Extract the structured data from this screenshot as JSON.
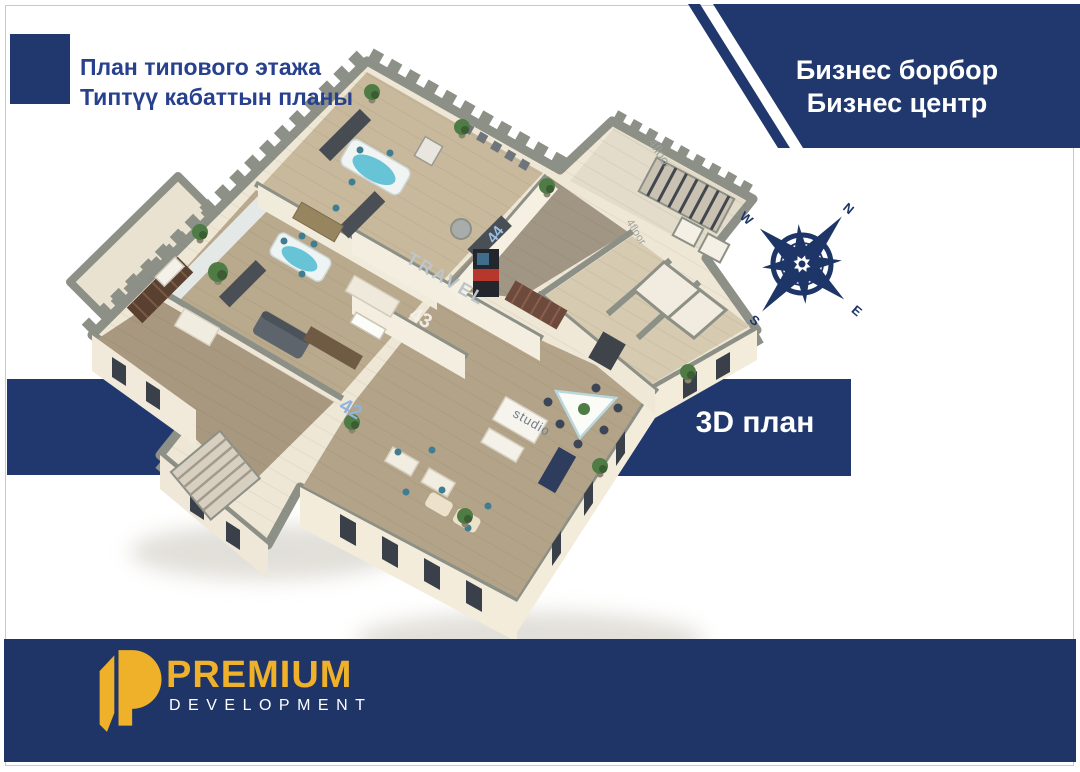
{
  "canvas": {
    "width": 1080,
    "height": 772,
    "background": "#ffffff",
    "frame_color": "#c6c9cf"
  },
  "brand_colors": {
    "navy": "#21386e",
    "navy_footer": "#1f3568",
    "gold": "#efb02a",
    "wall_cap_gray": "#8d9086",
    "wall_cream": "#efe7d6",
    "floor_wood": "#b3a388",
    "accent_teal": "#66c4d6",
    "white": "#ffffff"
  },
  "header": {
    "title_line1": "План типового этажа",
    "title_line2": "Типтүү кабаттын планы",
    "banner": {
      "line1": "Бизнес борбор",
      "line2": "Бизнес центр"
    }
  },
  "badge_3d": {
    "label": "3D план"
  },
  "compass": {
    "n": "N",
    "e": "E",
    "s": "S",
    "w": "W"
  },
  "floor_plan": {
    "decals": {
      "travel": "TRAVEL",
      "unit42": "42",
      "unit43": "43",
      "unit44": "44",
      "studio": "studio",
      "floor_label_a": "4floor",
      "floor_label_b": "4floor"
    }
  },
  "footer": {
    "brand": "PREMIUM",
    "subtitle": "DEVELOPMENT"
  }
}
